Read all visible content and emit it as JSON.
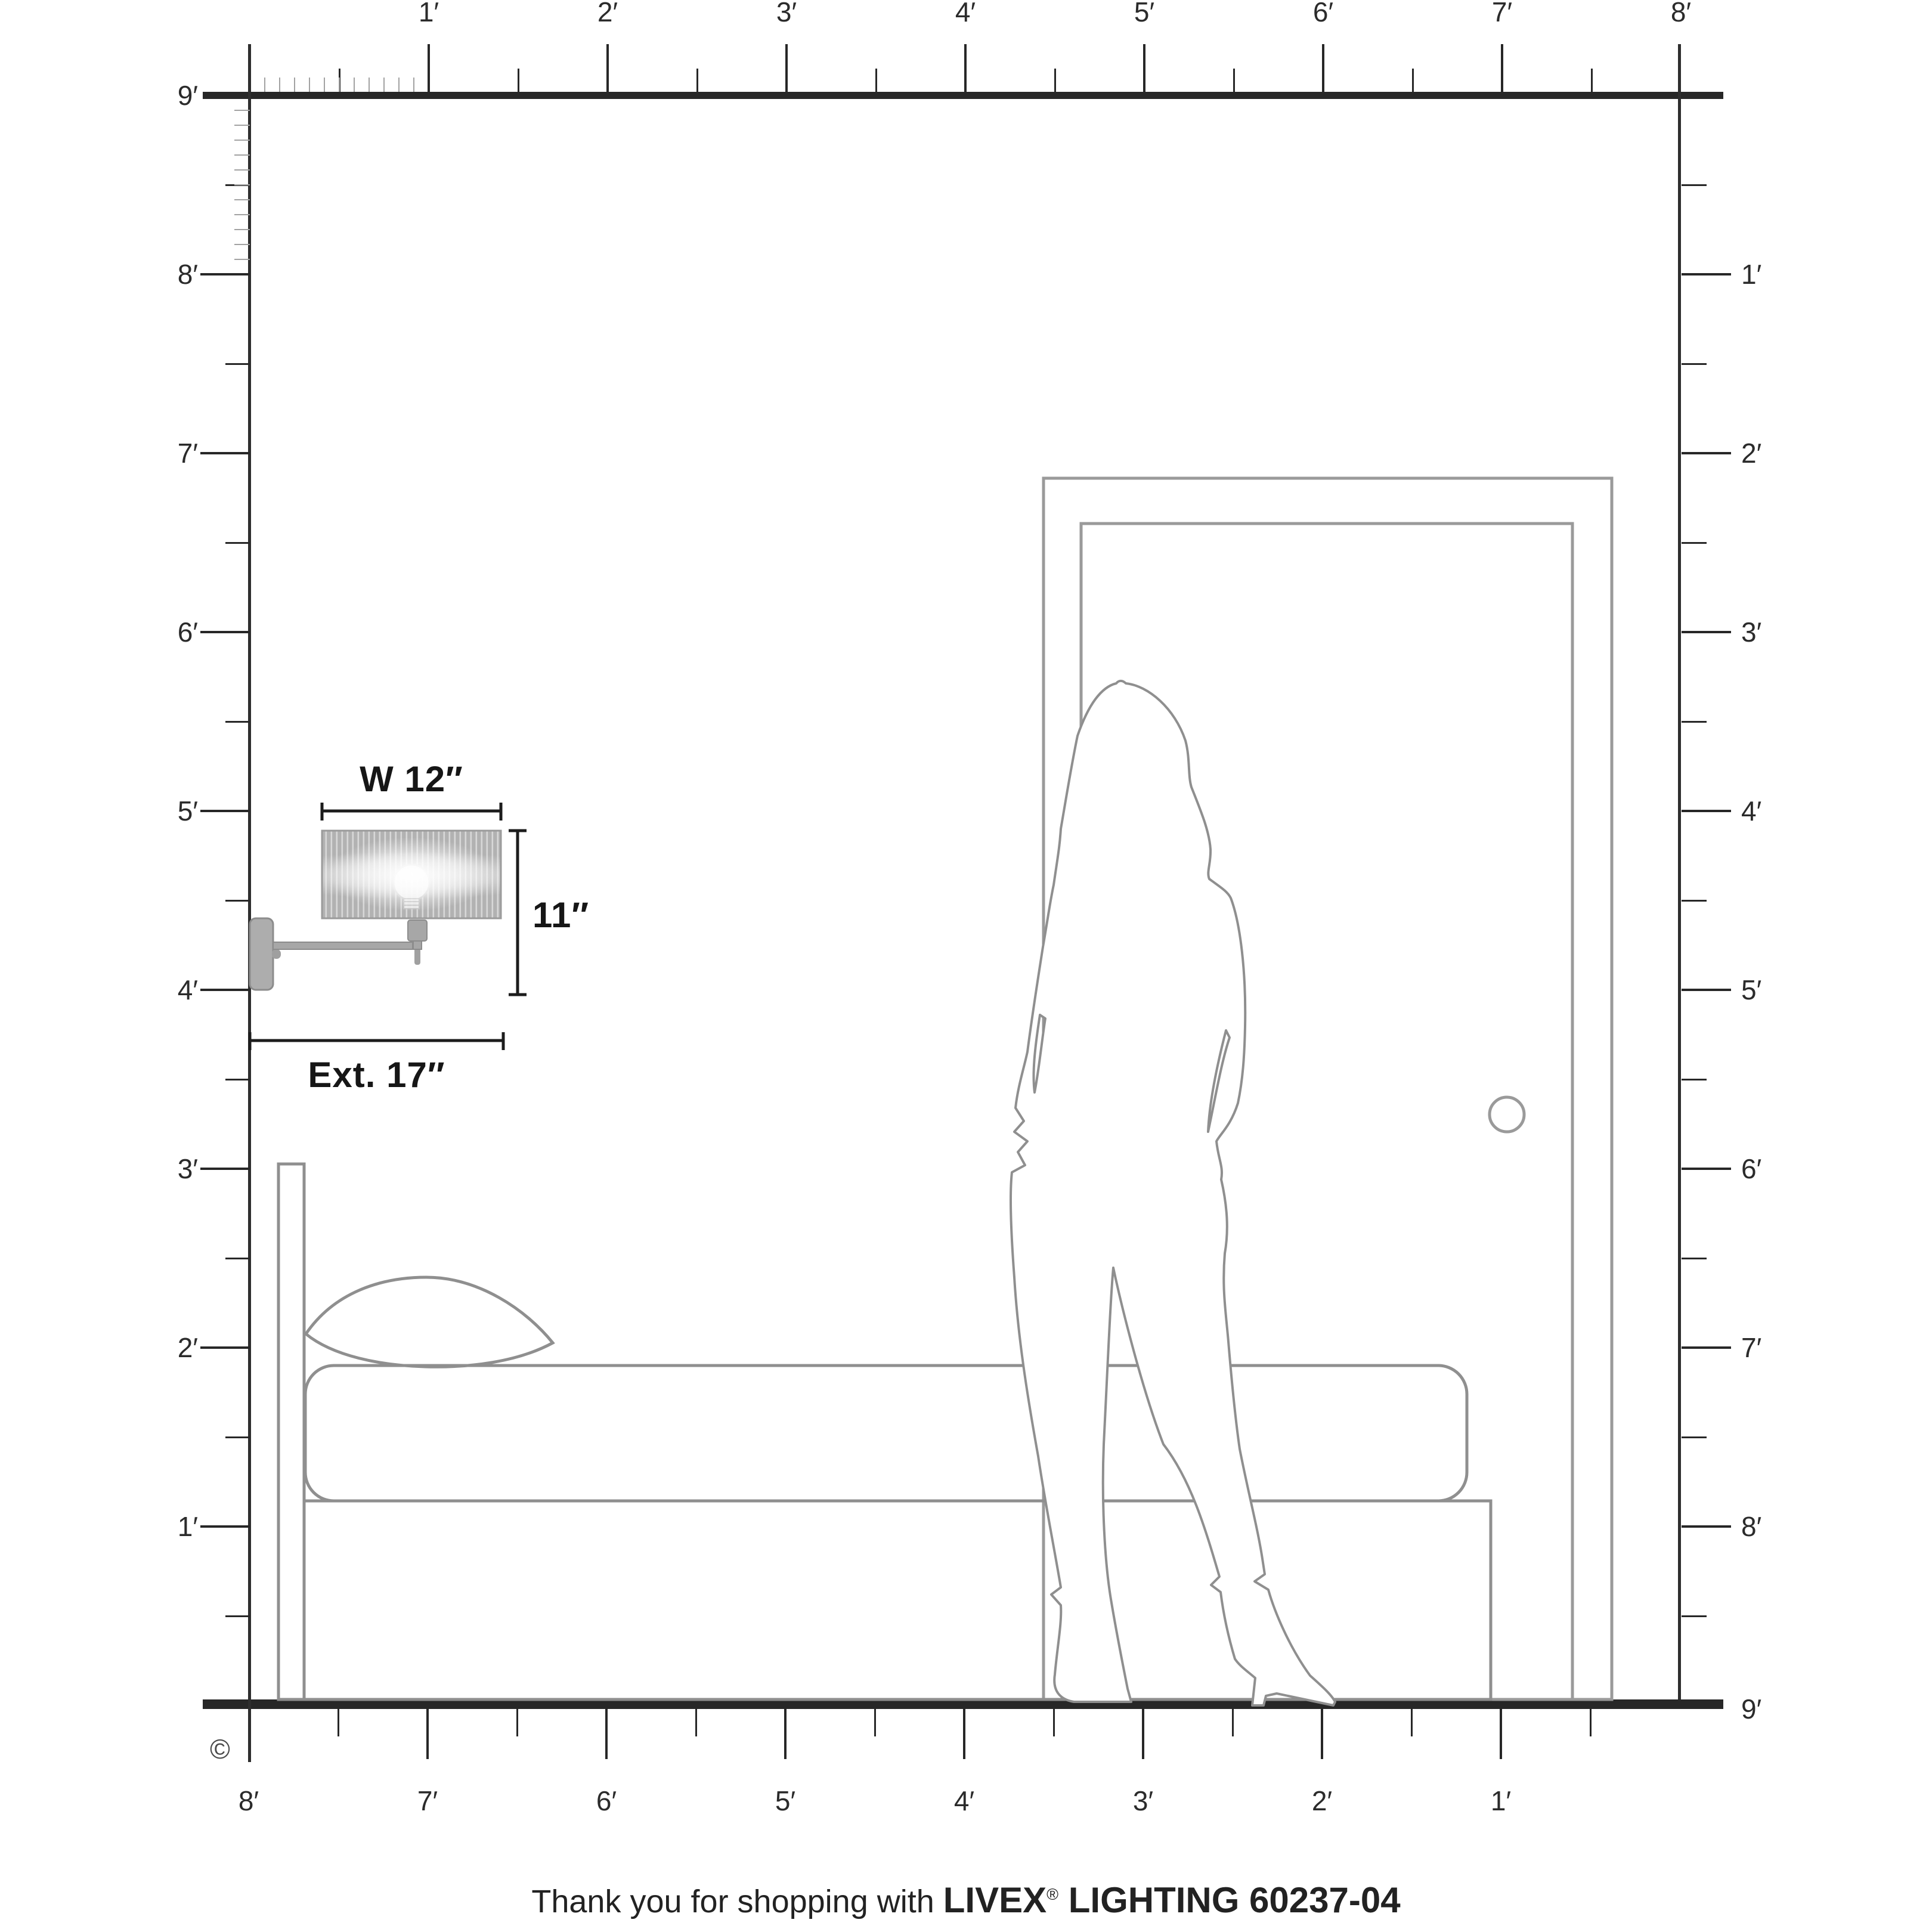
{
  "page": {
    "background": "#ffffff"
  },
  "rulers": {
    "top": [
      "1′",
      "2′",
      "3′",
      "4′",
      "5′",
      "6′",
      "7′",
      "8′"
    ],
    "left": [
      "9′",
      "8′",
      "7′",
      "6′",
      "5′",
      "4′",
      "3′",
      "2′",
      "1′"
    ],
    "right": [
      "1′",
      "2′",
      "3′",
      "4′",
      "5′",
      "6′",
      "7′",
      "8′",
      "9′"
    ],
    "bottom": [
      "1′",
      "2′",
      "3′",
      "4′",
      "5′",
      "6′",
      "7′",
      "8′"
    ]
  },
  "dimensions": {
    "width_label": "W 12″",
    "height_label": "11″",
    "extension_label": "Ext. 17″"
  },
  "copyright_symbol": "©",
  "footer": {
    "prefix": "Thank you for shopping with ",
    "brand": "LIVEX",
    "registered": "®",
    "suffix": " LIGHTING 60237-04"
  },
  "colors": {
    "ruler_ink": "#272727",
    "minor_inch_tick": "#a2a2a2",
    "dimension_ink": "#1c1c1c",
    "furniture_line": "#8f8f8f",
    "door_line": "#9a9a9a",
    "metal": "#a7a7a7",
    "metal_edge": "#8c8c8c",
    "shade_fill": "#b2b2b2",
    "shade_stripe": "#d8d8d8"
  }
}
